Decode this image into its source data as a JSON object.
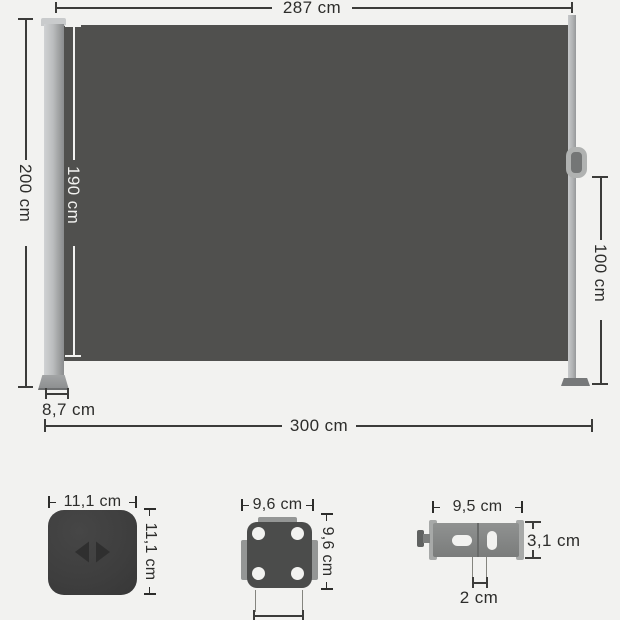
{
  "main": {
    "top_width": "287 cm",
    "left_height": "200 cm",
    "fabric_height": "190 cm",
    "right_height": "100 cm",
    "post_depth": "8,7 cm",
    "bottom_width": "300 cm"
  },
  "parts": {
    "cap": {
      "width": "11,1 cm",
      "height": "11,1 cm"
    },
    "plate": {
      "width": "9,6 cm",
      "height": "9,6 cm"
    },
    "bracket": {
      "width": "9,5 cm",
      "height": "3,1 cm",
      "slot": "2 cm"
    }
  },
  "colors": {
    "bg": "#f2f2f0",
    "ink": "#2d2d2b",
    "line": "#3c3c3a",
    "whiteline": "#f2f2f0",
    "fabric": "#50504e"
  }
}
